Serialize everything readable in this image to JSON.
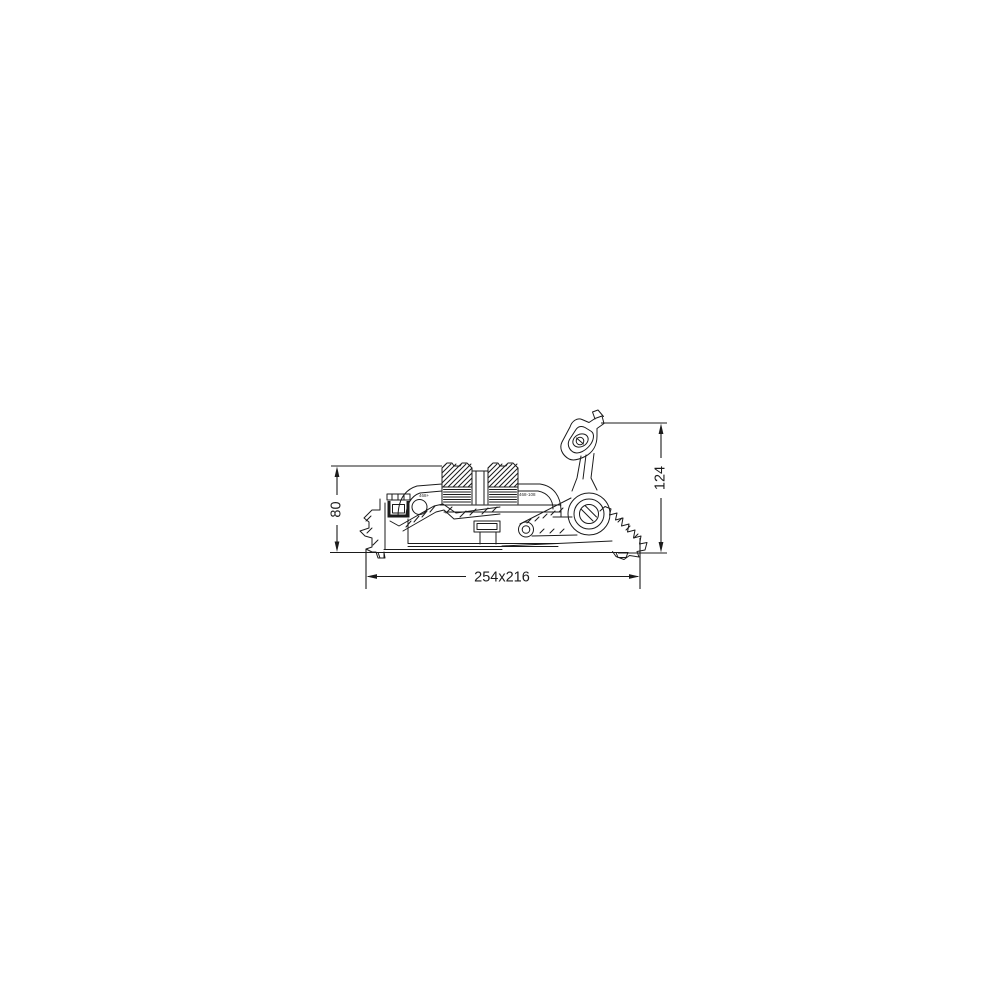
{
  "page": {
    "background": "#ffffff",
    "ink_color": "#1b1b1b"
  },
  "drawing": {
    "type": "technical side-view cross-section of window vent hardware",
    "dimensions": {
      "left_height": "80",
      "right_height": "124",
      "footprint": "254x216"
    },
    "stamps": {
      "left": "468+",
      "right": "468-108"
    }
  }
}
